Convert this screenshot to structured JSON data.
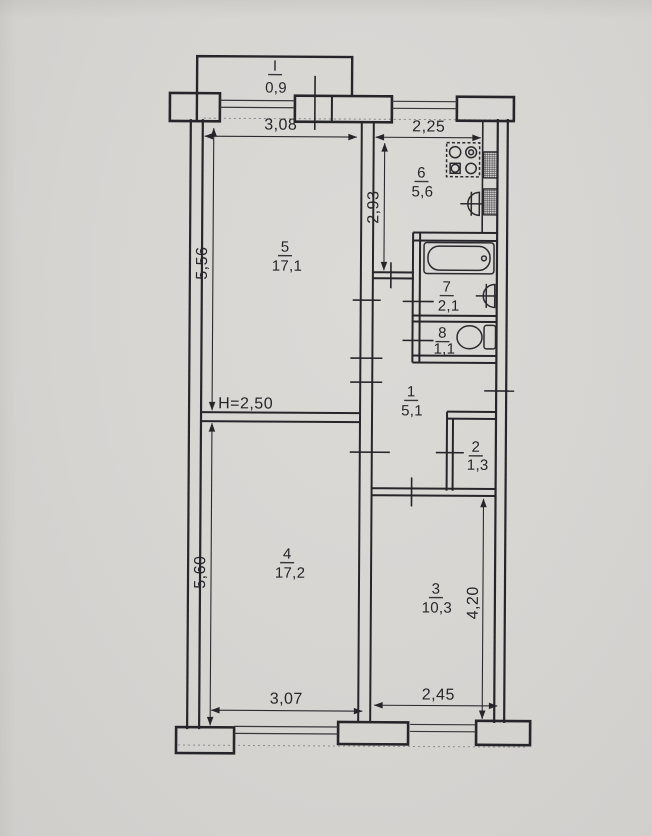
{
  "plan": {
    "balcony": {
      "number": "I",
      "area": "0,9"
    },
    "rooms": [
      {
        "number": "1",
        "area": "5,1"
      },
      {
        "number": "2",
        "area": "1,3"
      },
      {
        "number": "3",
        "area": "10,3"
      },
      {
        "number": "4",
        "area": "17,2"
      },
      {
        "number": "5",
        "area": "17,1"
      },
      {
        "number": "6",
        "area": "5,6"
      },
      {
        "number": "7",
        "area": "2,1"
      },
      {
        "number": "8",
        "area": "1,1"
      }
    ],
    "dims": {
      "top_left": "3,08",
      "top_right": "2,25",
      "kitchen_depth": "2,93",
      "left_upper": "5,56",
      "left_lower": "5,60",
      "bottom_left": "3,07",
      "bottom_right": "2,45",
      "right_lower": "4,20",
      "ceiling_height": "H=2,50"
    }
  }
}
